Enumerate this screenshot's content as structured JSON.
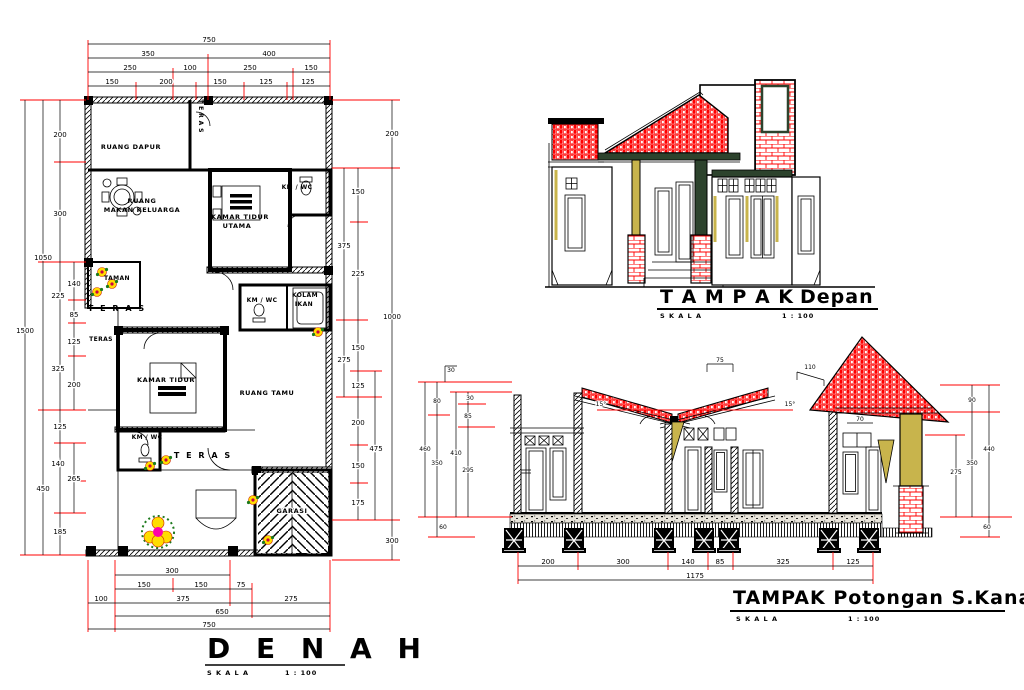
{
  "plan": {
    "title": "D E N A H",
    "scale_label": "S K A L A",
    "scale_value": "1 : 100",
    "rooms": {
      "dapur": "RUANG DAPUR",
      "teras_top": "T E R A S",
      "ruang_makan_1": "RUANG",
      "ruang_makan_2": "MAKAN KELUARGA",
      "kamar_utama_1": "KAMAR TIDUR",
      "kamar_utama_2": "UTAMA",
      "kmwc_top": "KM / WC",
      "taman": "TAMAN",
      "teras_left": "T E R A S",
      "teras_small": "TERAS",
      "kmwc_mid": "KM / WC",
      "kolam_1": "KOLAM",
      "kolam_2": "IKAN",
      "kamar_tidur": "KAMAR TIDUR",
      "ruang_tamu": "RUANG TAMU",
      "kmwc_bottom": "KM / WC",
      "teras_mid": "T E R A S",
      "garasi": "GARASI"
    },
    "dims": {
      "top": [
        "750",
        "350",
        "400",
        "250",
        "100",
        "250",
        "150",
        "150",
        "200",
        "150",
        "125",
        "125"
      ],
      "left": [
        "200",
        "300",
        "1050",
        "140",
        "225",
        "85",
        "125",
        "325",
        "200",
        "125",
        "265",
        "140",
        "450",
        "185",
        "1500"
      ],
      "right": [
        "200",
        "150",
        "375",
        "225",
        "150",
        "275",
        "125",
        "200",
        "475",
        "150",
        "175",
        "300",
        "1000"
      ],
      "bottom": [
        "300",
        "150",
        "150",
        "75",
        "100",
        "375",
        "275",
        "650",
        "750"
      ]
    }
  },
  "elevation": {
    "title_main": "T A M P A K",
    "title_sub": "Depan",
    "scale_label": "S K A L A",
    "scale_value": "1 : 100"
  },
  "section": {
    "title": "TAMPAK Potongan S.Kanan",
    "scale_label": "S K A L A",
    "scale_value": "1 : 100",
    "dims": {
      "bottom": [
        "200",
        "300",
        "140",
        "85",
        "325",
        "125",
        "1175"
      ],
      "left": [
        "30",
        "80",
        "460",
        "410",
        "350",
        "30",
        "85",
        "295",
        "60"
      ],
      "right": [
        "90",
        "440",
        "350",
        "275",
        "60"
      ],
      "mid": [
        "75",
        "110",
        "15°",
        "15°",
        "70"
      ]
    }
  },
  "colors": {
    "brick_red": "#ff0000",
    "khaki": "#c8b44c",
    "dark_green": "#2d432d",
    "dimension_red": "#ff0000"
  }
}
